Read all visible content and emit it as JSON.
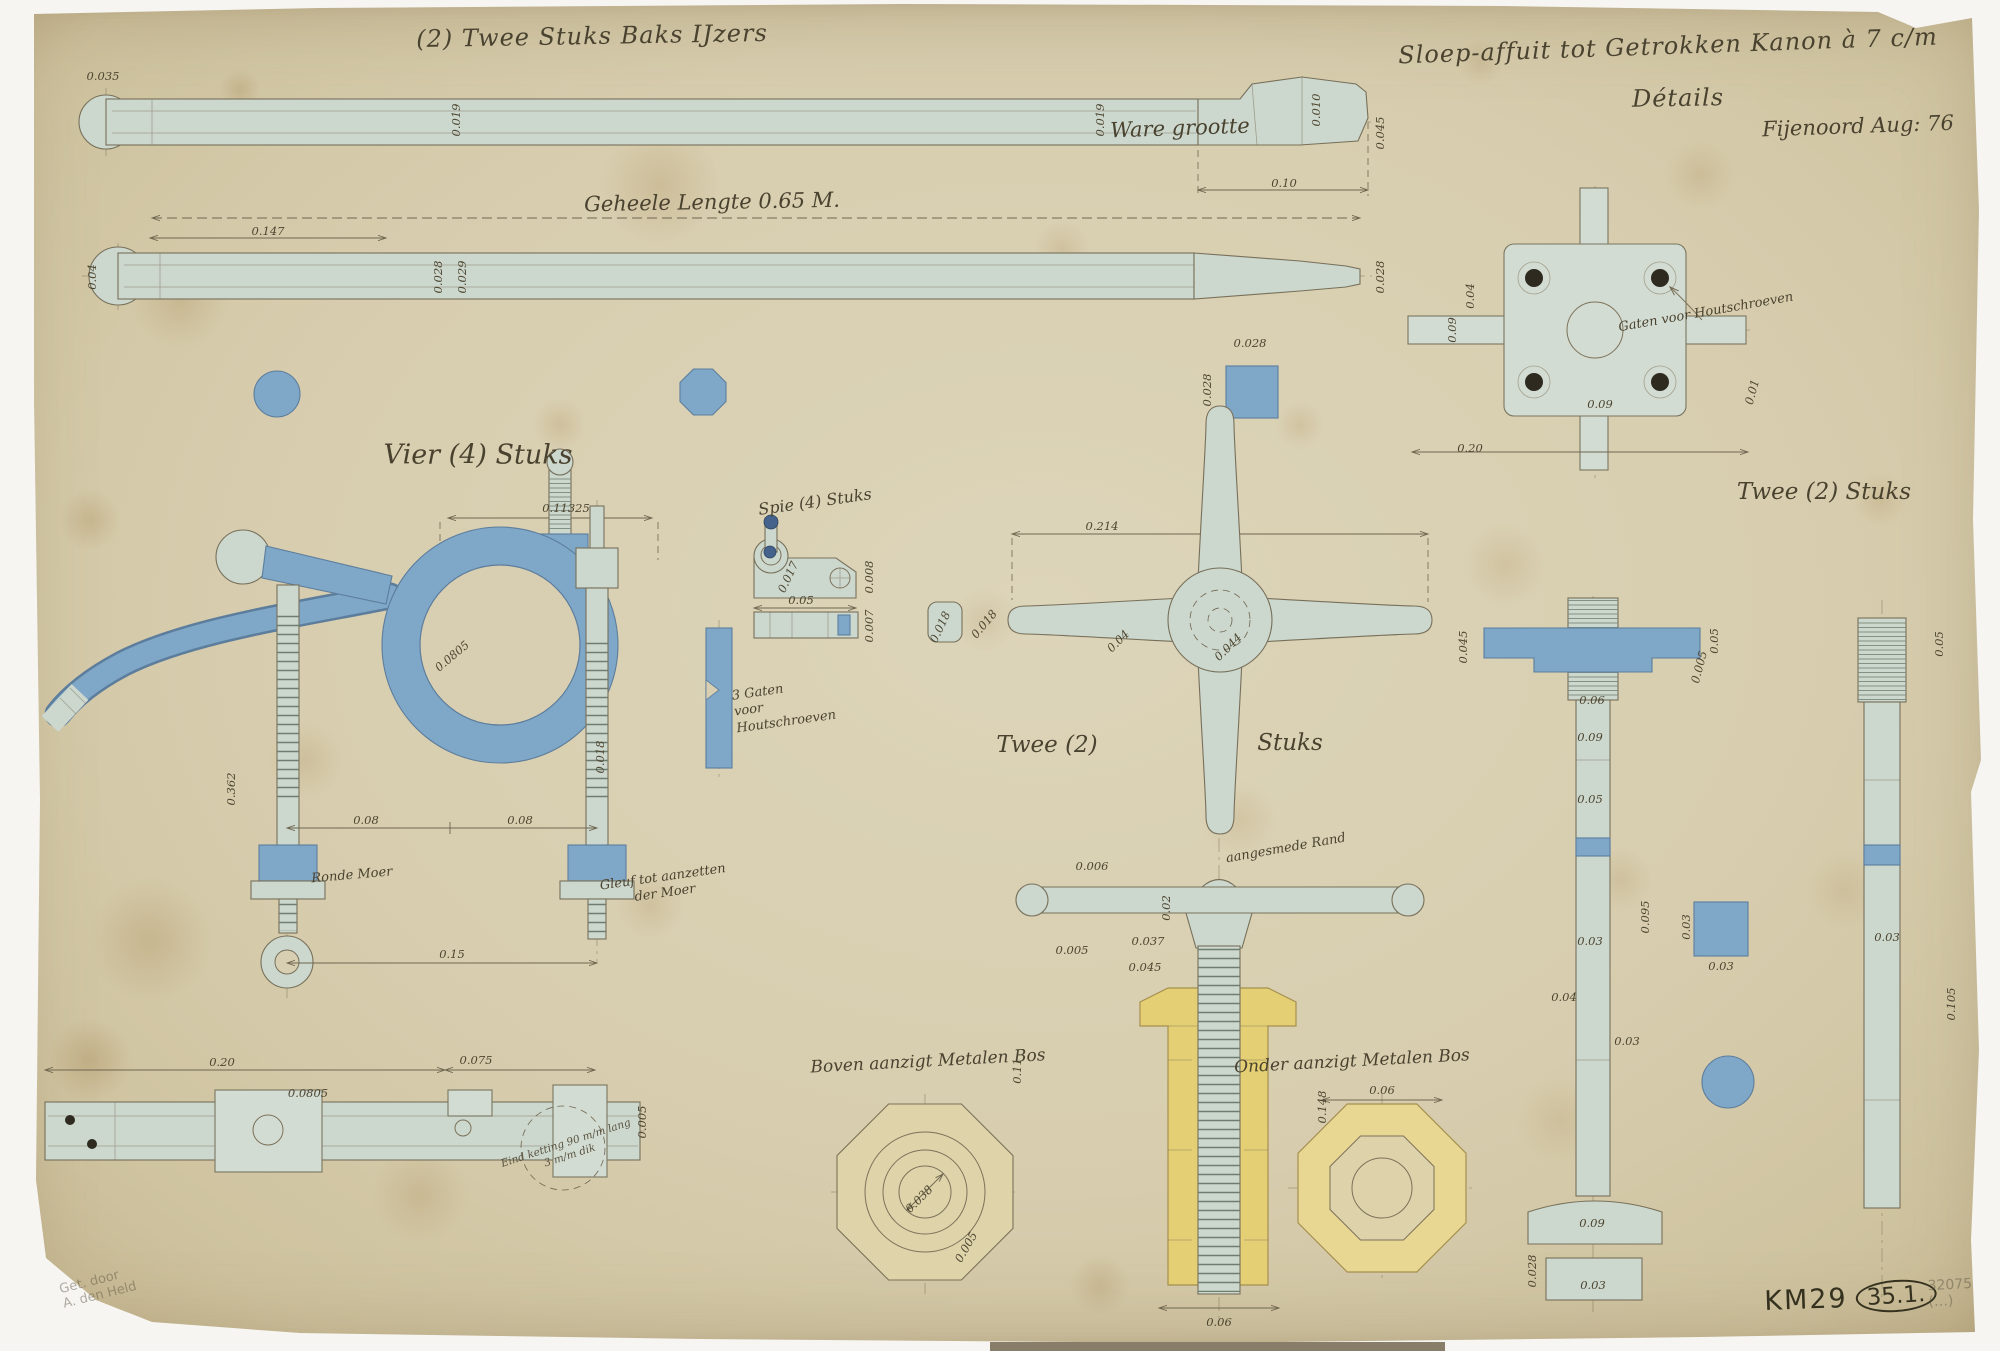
{
  "palette": {
    "paper": "#d8cfb2",
    "steel_wash": "#ccd7cd",
    "iron_blue_wash": "#7fa7c7",
    "brass_yellow_wash": "#e4cf74",
    "ink_line": "#7c725a",
    "ink_text": "#49422f",
    "pencil": "#8a8174"
  },
  "titles": {
    "top_left": "(2) Twee Stuks Baks IJzers",
    "main": "Sloep-affuit tot Getrokken Kanon à 7 c/m",
    "subtitle": "Détails",
    "scale": "Ware grootte",
    "place_date": "Fijenoord Aug: 76"
  },
  "labels": {
    "overall_length": "Geheele Lengte 0.65 M.",
    "vier_stuks": "Vier (4) Stuks",
    "spie_stuks": "Spie (4) Stuks",
    "twee_left": "Twee (2)",
    "stuks_right": "Stuks",
    "twee_stuks_right": "Twee (2) Stuks",
    "boven_aanzigt": "Boven aanzigt Metalen Bos",
    "onder_aanzigt": "Onder aanzigt Metalen Bos"
  },
  "notes": {
    "gaten": "Gaten voor Houtschroeven",
    "drie_gaten": "3 Gaten\nvoor\nHoutschroeven",
    "ronde_moer": "Ronde Moer",
    "gleuf": "Gleuf tot aanzetten\nder Moer",
    "aangesmede_rand": "aangesmede Rand",
    "eind_ketting": "Eind ketting 90 m/m lang\n3 m/m dik"
  },
  "stamps": {
    "km": "KM29",
    "ref": "35.1.",
    "pencil_number": "32075 (…)",
    "signature": "Get. door\nA. den Held"
  },
  "dim_labels": [
    {
      "t": "0.035",
      "x": 103,
      "y": 76,
      "r": 0
    },
    {
      "t": "0.019",
      "x": 456,
      "y": 120,
      "r": -90
    },
    {
      "t": "0.019",
      "x": 1100,
      "y": 120,
      "r": -90
    },
    {
      "t": "0.010",
      "x": 1316,
      "y": 110,
      "r": -90
    },
    {
      "t": "0.045",
      "x": 1380,
      "y": 133,
      "r": -90
    },
    {
      "t": "0.10",
      "x": 1284,
      "y": 183,
      "r": 0
    },
    {
      "t": "0.147",
      "x": 268,
      "y": 231,
      "r": 0
    },
    {
      "t": "0.04",
      "x": 92,
      "y": 277,
      "r": -90
    },
    {
      "t": "0.028",
      "x": 438,
      "y": 277,
      "r": -90
    },
    {
      "t": "0.029",
      "x": 462,
      "y": 277,
      "r": -90
    },
    {
      "t": "0.028",
      "x": 1380,
      "y": 277,
      "r": -90
    },
    {
      "t": "0.028",
      "x": 1250,
      "y": 343,
      "r": 0
    },
    {
      "t": "0.028",
      "x": 1207,
      "y": 390,
      "r": -90
    },
    {
      "t": "0.09",
      "x": 1452,
      "y": 330,
      "r": -90
    },
    {
      "t": "0.04",
      "x": 1470,
      "y": 296,
      "r": -90
    },
    {
      "t": "0.09",
      "x": 1600,
      "y": 404,
      "r": 0
    },
    {
      "t": "0.01",
      "x": 1752,
      "y": 392,
      "r": -75
    },
    {
      "t": "0.20",
      "x": 1470,
      "y": 448,
      "r": 0
    },
    {
      "t": "0.11325",
      "x": 566,
      "y": 508,
      "r": 0
    },
    {
      "t": "0.0805",
      "x": 452,
      "y": 656,
      "r": -40
    },
    {
      "t": "0.362",
      "x": 231,
      "y": 789,
      "r": -90
    },
    {
      "t": "0.018",
      "x": 600,
      "y": 757,
      "r": -90
    },
    {
      "t": "0.08",
      "x": 366,
      "y": 820,
      "r": 0
    },
    {
      "t": "0.08",
      "x": 520,
      "y": 820,
      "r": 0
    },
    {
      "t": "0.15",
      "x": 452,
      "y": 954,
      "r": 0
    },
    {
      "t": "0.017",
      "x": 788,
      "y": 577,
      "r": -65
    },
    {
      "t": "0.008",
      "x": 869,
      "y": 577,
      "r": -90
    },
    {
      "t": "0.05",
      "x": 801,
      "y": 600,
      "r": 0
    },
    {
      "t": "0.007",
      "x": 869,
      "y": 626,
      "r": -90
    },
    {
      "t": "0.018",
      "x": 940,
      "y": 627,
      "r": -65
    },
    {
      "t": "0.214",
      "x": 1102,
      "y": 526,
      "r": 0
    },
    {
      "t": "0.018",
      "x": 984,
      "y": 624,
      "r": -50
    },
    {
      "t": "0.04",
      "x": 1118,
      "y": 641,
      "r": -45
    },
    {
      "t": "0.044",
      "x": 1228,
      "y": 647,
      "r": -45
    },
    {
      "t": "0.006",
      "x": 1092,
      "y": 866,
      "r": 0
    },
    {
      "t": "0.02",
      "x": 1166,
      "y": 908,
      "r": -90
    },
    {
      "t": "0.037",
      "x": 1148,
      "y": 941,
      "r": 0
    },
    {
      "t": "0.005",
      "x": 1072,
      "y": 950,
      "r": 0
    },
    {
      "t": "0.045",
      "x": 1145,
      "y": 967,
      "r": 0
    },
    {
      "t": "0.11",
      "x": 1017,
      "y": 1071,
      "r": -90
    },
    {
      "t": "0.148",
      "x": 1322,
      "y": 1107,
      "r": -90
    },
    {
      "t": "0.06",
      "x": 1219,
      "y": 1322,
      "r": 0
    },
    {
      "t": "0.038",
      "x": 919,
      "y": 1199,
      "r": -45
    },
    {
      "t": "0.005",
      "x": 966,
      "y": 1247,
      "r": -60
    },
    {
      "t": "0.06",
      "x": 1382,
      "y": 1090,
      "r": 0
    },
    {
      "t": "0.05",
      "x": 1714,
      "y": 641,
      "r": -90
    },
    {
      "t": "0.045",
      "x": 1463,
      "y": 647,
      "r": -90
    },
    {
      "t": "0.005",
      "x": 1699,
      "y": 667,
      "r": -75
    },
    {
      "t": "0.06",
      "x": 1592,
      "y": 700,
      "r": 0
    },
    {
      "t": "0.09",
      "x": 1590,
      "y": 737,
      "r": 0
    },
    {
      "t": "0.05",
      "x": 1590,
      "y": 799,
      "r": 0
    },
    {
      "t": "0.03",
      "x": 1590,
      "y": 941,
      "r": 0
    },
    {
      "t": "0.095",
      "x": 1645,
      "y": 917,
      "r": -90
    },
    {
      "t": "0.04",
      "x": 1564,
      "y": 997,
      "r": 0
    },
    {
      "t": "0.03",
      "x": 1627,
      "y": 1041,
      "r": 0
    },
    {
      "t": "0.03",
      "x": 1686,
      "y": 927,
      "r": -90
    },
    {
      "t": "0.03",
      "x": 1721,
      "y": 966,
      "r": 0
    },
    {
      "t": "0.09",
      "x": 1592,
      "y": 1223,
      "r": 0
    },
    {
      "t": "0.03",
      "x": 1593,
      "y": 1285,
      "r": 0
    },
    {
      "t": "0.028",
      "x": 1532,
      "y": 1271,
      "r": -90
    },
    {
      "t": "0.05",
      "x": 1939,
      "y": 644,
      "r": -90
    },
    {
      "t": "0.03",
      "x": 1887,
      "y": 937,
      "r": 0
    },
    {
      "t": "0.105",
      "x": 1951,
      "y": 1004,
      "r": -90
    },
    {
      "t": "0.20",
      "x": 222,
      "y": 1062,
      "r": 0
    },
    {
      "t": "0.075",
      "x": 476,
      "y": 1060,
      "r": 0
    },
    {
      "t": "0.0805",
      "x": 308,
      "y": 1093,
      "r": 0
    },
    {
      "t": "0.005",
      "x": 642,
      "y": 1122,
      "r": -90
    }
  ]
}
